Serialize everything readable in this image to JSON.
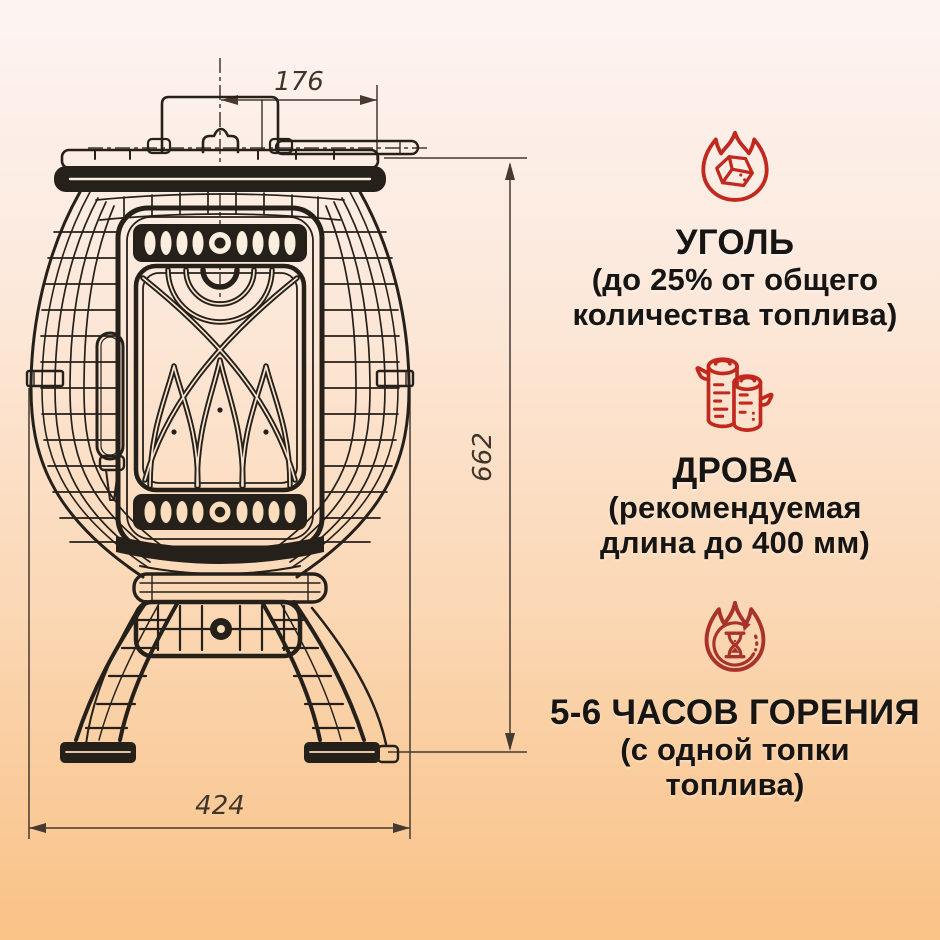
{
  "page": {
    "background_top_color": "#fdf4f2",
    "background_bottom_color": "#f9c286"
  },
  "drawing": {
    "line_color": "#26201a",
    "dimension_line_color": "#453931",
    "dimensions": {
      "top_width_mm": "176",
      "height_mm": "662",
      "base_width_mm": "424"
    }
  },
  "info": {
    "accent_red": "#c1281e",
    "accent_red_dark": "#a8322c",
    "text_color": "#171513",
    "sections": [
      {
        "icon": "coal-flame-icon",
        "title": "УГОЛЬ",
        "line1": "(до 25% от общего",
        "line2": "количества топлива)"
      },
      {
        "icon": "firewood-icon",
        "title": "ДРОВА",
        "line1": "(рекомендуемая",
        "line2": "длина до 400 мм)"
      },
      {
        "icon": "burn-time-icon",
        "title": "5-6 ЧАСОВ ГОРЕНИЯ",
        "line1": "(с одной топки",
        "line2": "топлива)"
      }
    ]
  }
}
